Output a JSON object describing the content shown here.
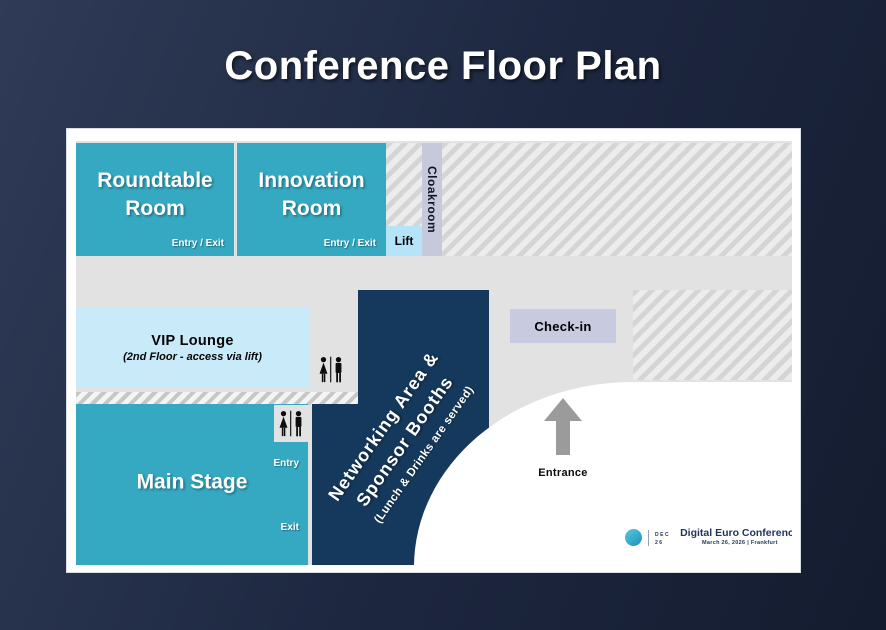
{
  "title": "Conference Floor Plan",
  "floor": {
    "roundtable_room": {
      "name": "Roundtable Room",
      "door": "Entry / Exit"
    },
    "innovation_room": {
      "name": "Innovation Room",
      "door": "Entry / Exit"
    },
    "lift": {
      "name": "Lift"
    },
    "cloakroom": {
      "name": "Cloakroom"
    },
    "vip_lounge": {
      "name": "VIP Lounge",
      "note": "(2nd Floor - access via lift)"
    },
    "check_in": {
      "name": "Check-in"
    },
    "main_stage": {
      "name": "Main Stage",
      "entry": "Entry",
      "exit": "Exit"
    },
    "networking": {
      "line1": "Networking Area &",
      "line2": "Sponsor Booths",
      "note": "(Lunch & Drinks are served)"
    },
    "entrance": {
      "name": "Entrance"
    }
  },
  "branding": {
    "badge_line1": "DEC",
    "badge_line2": "26",
    "name": "Digital Euro Conference",
    "date": "March 26, 2026 | Frankfurt"
  },
  "icons": {
    "restroom": "restroom-icon",
    "entrance_arrow": "up-arrow-icon"
  },
  "colors": {
    "bg1": "#2f3b57",
    "bg2": "#1d2740",
    "bg3": "#141c2f",
    "floor": "#e2e2e2",
    "teal": "#35a8c2",
    "navy": "#15395c",
    "vip": "#c8eaf9",
    "lift": "#b5e3f8",
    "cloakroom": "#c6c9dc",
    "checkin": "#c8cbe0",
    "arrow": "#9b9b9b",
    "logo_navy": "#23345c"
  }
}
